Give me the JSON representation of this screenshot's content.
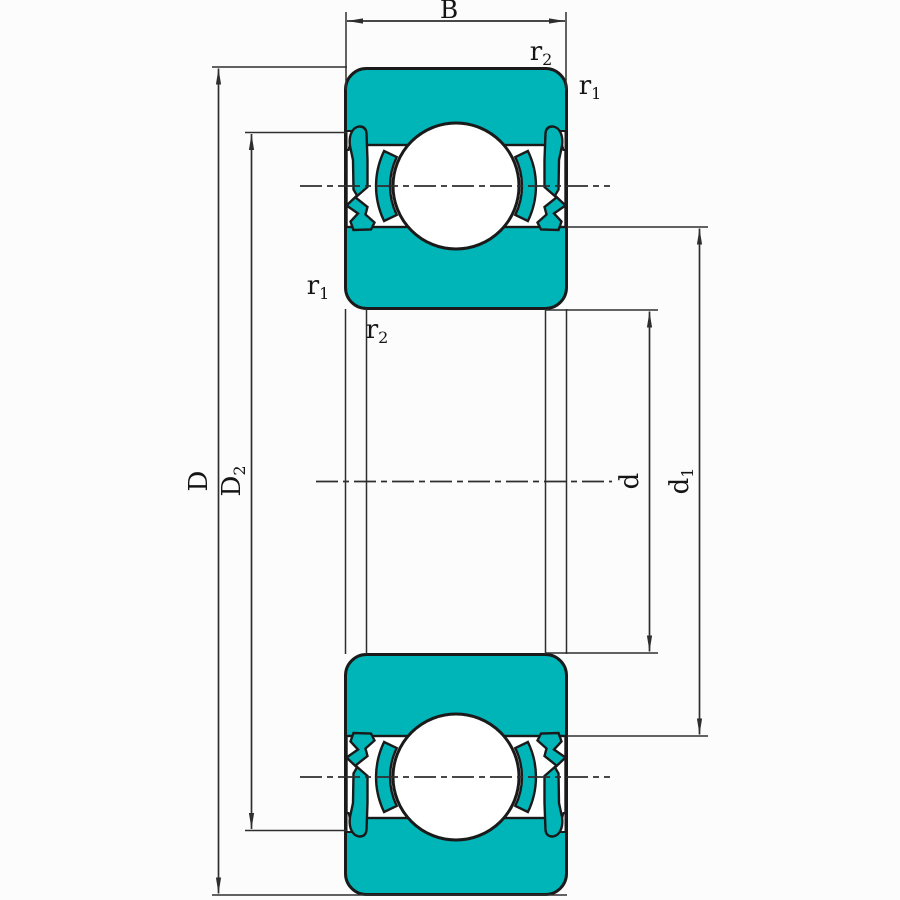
{
  "diagram": {
    "dimension_labels": {
      "B": {
        "base": "B",
        "sub": ""
      },
      "D": {
        "base": "D",
        "sub": ""
      },
      "D2": {
        "base": "D",
        "sub": "2"
      },
      "d": {
        "base": "d",
        "sub": ""
      },
      "d1": {
        "base": "d",
        "sub": "1"
      }
    },
    "corner_labels": {
      "r2_top": {
        "base": "r",
        "sub": "2"
      },
      "r1_top": {
        "base": "r",
        "sub": "1"
      },
      "r1_left": {
        "base": "r",
        "sub": "1"
      },
      "r2_left": {
        "base": "r",
        "sub": "2"
      }
    },
    "colors": {
      "part_fill": "#00B5B8",
      "outline": "#1A1A1A",
      "dimension_lines": "#2E2E2E",
      "background": "#FCFCFC"
    }
  }
}
